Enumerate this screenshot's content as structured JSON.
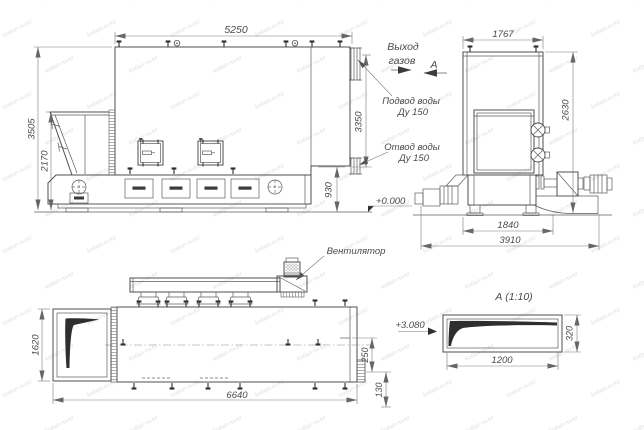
{
  "watermark": {
    "text": "kotlan-nv.kz"
  },
  "side": {
    "d_width": "5250",
    "d_total_h": "3505",
    "d_hopper_h": "2170",
    "d_supply_h": "3350",
    "d_return_h": "930",
    "gas1": "Выход",
    "gas2": "газов",
    "supply1": "Подвод воды",
    "supply2": "Ду 150",
    "ret1": "Отвод воды",
    "ret2": "Ду 150",
    "level": "+0.000",
    "section": "А"
  },
  "front": {
    "d_top": "1767",
    "d_height": "2630",
    "d_base": "1840",
    "d_total": "3910"
  },
  "plan": {
    "d_depth": "1620",
    "d_length": "6640",
    "d_stub_a": "250",
    "d_stub_b": "130",
    "fan": "Вентилятор",
    "level": "+3.080"
  },
  "sectionA": {
    "title": "А  (1:10)",
    "d_w": "1200",
    "d_h": "320"
  }
}
